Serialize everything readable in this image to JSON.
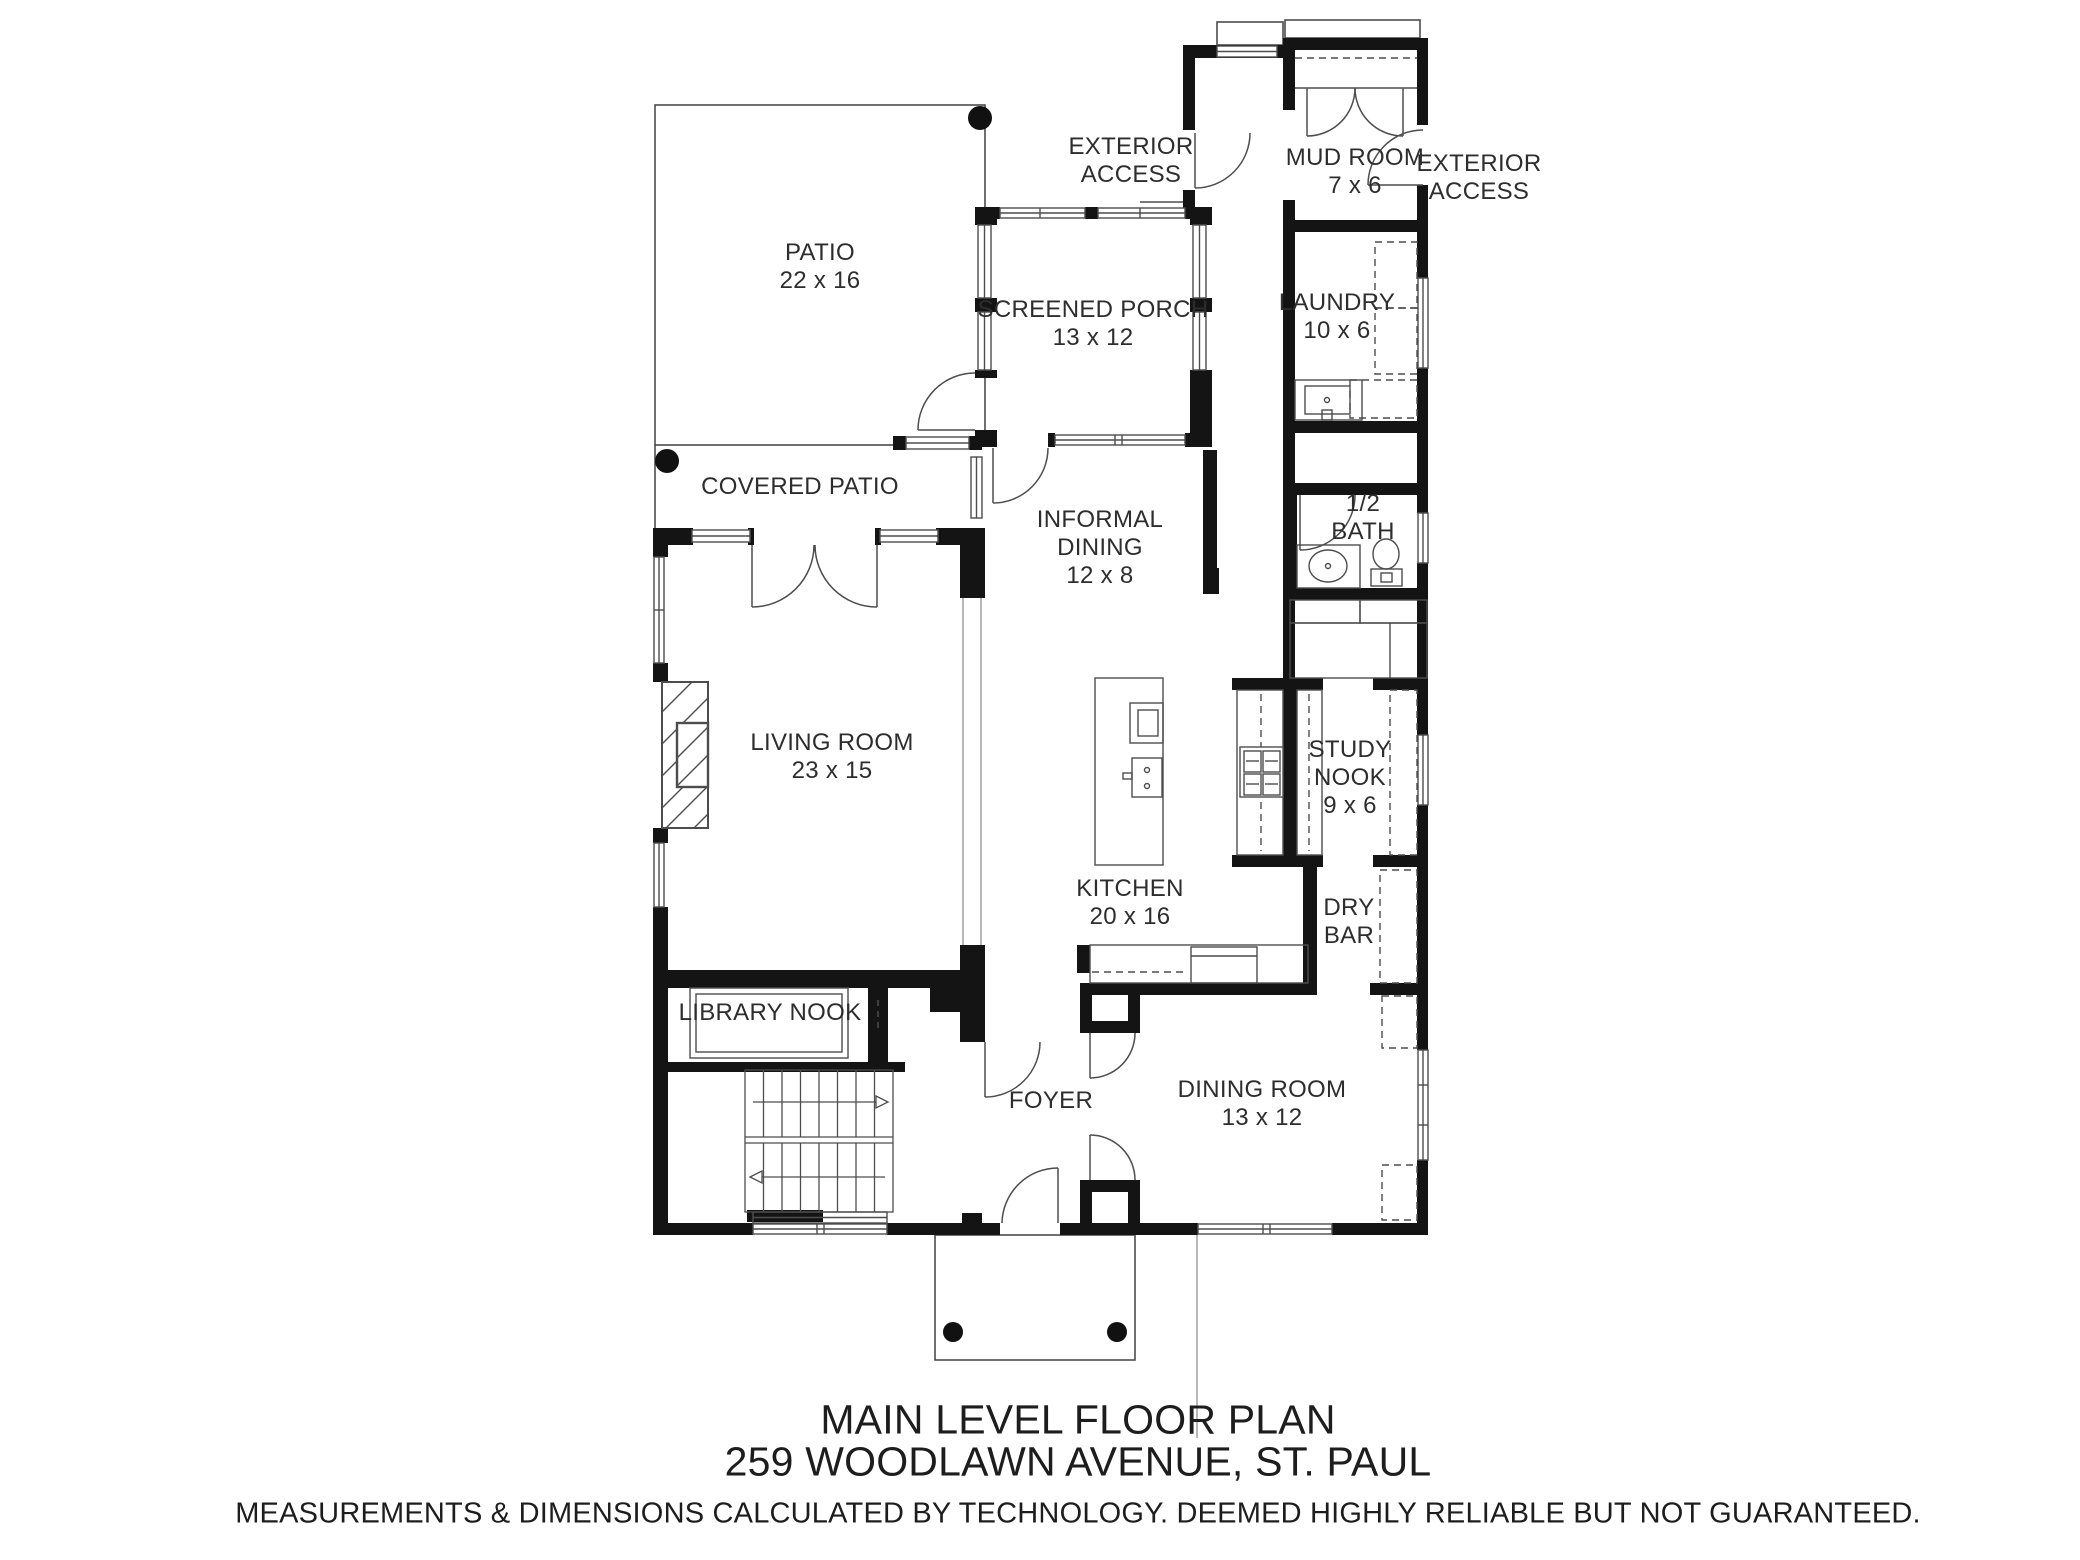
{
  "plan": {
    "rooms": {
      "patio": {
        "name": "PATIO",
        "dims": "22 x 16"
      },
      "covered_patio": {
        "name": "COVERED PATIO"
      },
      "screened_porch": {
        "name": "SCREENED PORCH",
        "dims": "13 x 12"
      },
      "mud_room": {
        "name": "MUD ROOM",
        "dims": "7 x 6"
      },
      "laundry": {
        "name": "LAUNDRY",
        "dims": "10 x 6"
      },
      "informal_dining": {
        "name": "INFORMAL DINING",
        "dims": "12 x 8"
      },
      "half_bath": {
        "name": "1/2 BATH"
      },
      "living_room": {
        "name": "LIVING ROOM",
        "dims": "23 x 15"
      },
      "kitchen": {
        "name": "KITCHEN",
        "dims": "20 x 16"
      },
      "study_nook": {
        "name": "STUDY NOOK",
        "dims": "9 x 6"
      },
      "dry_bar": {
        "name": "DRY BAR"
      },
      "library_nook": {
        "name": "LIBRARY NOOK"
      },
      "foyer": {
        "name": "FOYER"
      },
      "dining_room": {
        "name": "DINING ROOM",
        "dims": "13 x 12"
      }
    },
    "annotations": {
      "exterior_access_left": "EXTERIOR ACCESS",
      "exterior_access_right": "EXTERIOR ACCESS"
    },
    "title": {
      "line1": "MAIN LEVEL FLOOR PLAN",
      "line2": "259 WOODLAWN AVENUE, ST. PAUL",
      "disclaimer": "MEASUREMENTS & DIMENSIONS CALCULATED BY TECHNOLOGY. DEEMED HIGHLY RELIABLE BUT NOT GUARANTEED."
    },
    "colors": {
      "wall": "#141414",
      "line": "#4d4d4d",
      "background": "#ffffff",
      "label": "#2d2d2d"
    }
  }
}
